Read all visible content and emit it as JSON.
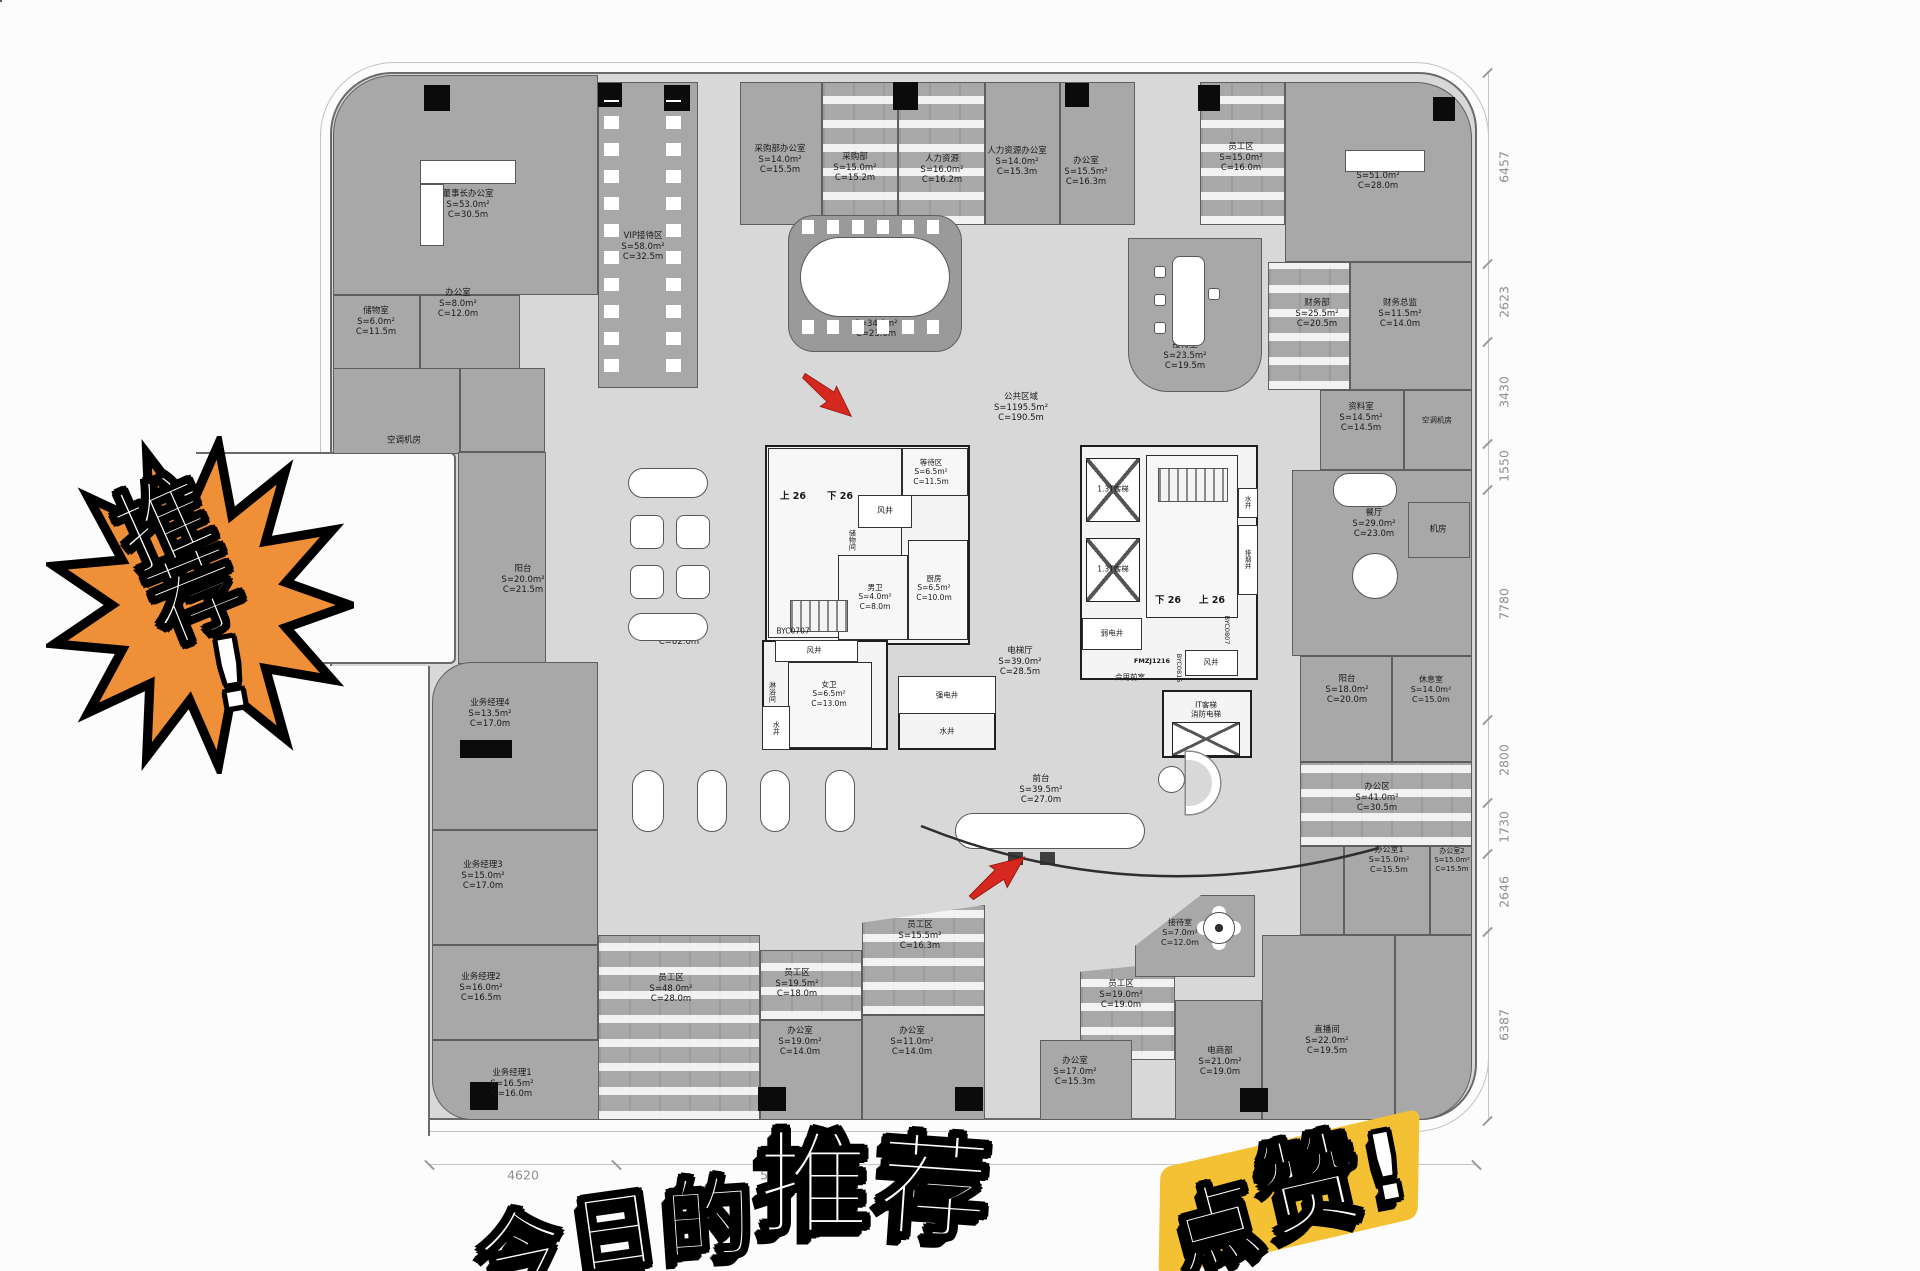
{
  "overlays": {
    "badge": {
      "text": "推荐!",
      "fill": "#ef8f38"
    },
    "title": {
      "text": "今日的推荐"
    },
    "like": {
      "text": "点赞!",
      "highlight": "#f4c134"
    }
  },
  "floorplan": {
    "public_area": {
      "name": "公共区域",
      "s": "S=1195.5m²",
      "c": "C=190.5m"
    },
    "rooms": [
      {
        "x": 333,
        "y": 75,
        "w": 265,
        "h": 220,
        "r": "60px 0 0 0"
      },
      {
        "x": 333,
        "y": 295,
        "w": 87,
        "h": 75
      },
      {
        "x": 420,
        "y": 295,
        "w": 100,
        "h": 75
      },
      {
        "x": 333,
        "y": 368,
        "w": 127,
        "h": 86
      },
      {
        "x": 460,
        "y": 368,
        "w": 85,
        "h": 84
      },
      {
        "x": 458,
        "y": 452,
        "w": 88,
        "h": 212
      },
      {
        "x": 598,
        "y": 82,
        "w": 100,
        "h": 306
      },
      {
        "x": 740,
        "y": 82,
        "w": 82,
        "h": 143
      },
      {
        "x": 822,
        "y": 82,
        "w": 76,
        "h": 143,
        "cls": "ws"
      },
      {
        "x": 898,
        "y": 82,
        "w": 87,
        "h": 143,
        "cls": "ws"
      },
      {
        "x": 985,
        "y": 82,
        "w": 75,
        "h": 143
      },
      {
        "x": 1060,
        "y": 82,
        "w": 75,
        "h": 143
      },
      {
        "x": 1200,
        "y": 82,
        "w": 85,
        "h": 143,
        "cls": "ws"
      },
      {
        "x": 1285,
        "y": 82,
        "w": 187,
        "h": 180,
        "r": "0 56px 0 0"
      },
      {
        "x": 788,
        "y": 215,
        "w": 174,
        "h": 137,
        "cls": "room2",
        "r": "26px"
      },
      {
        "x": 1128,
        "y": 238,
        "w": 134,
        "h": 154,
        "r": "0 0 40px 40px"
      },
      {
        "x": 1268,
        "y": 262,
        "w": 82,
        "h": 128,
        "cls": "ws"
      },
      {
        "x": 1350,
        "y": 262,
        "w": 122,
        "h": 128
      },
      {
        "x": 1320,
        "y": 390,
        "w": 84,
        "h": 80
      },
      {
        "x": 1404,
        "y": 390,
        "w": 68,
        "h": 80
      },
      {
        "x": 1292,
        "y": 470,
        "w": 180,
        "h": 186
      },
      {
        "x": 1408,
        "y": 502,
        "w": 62,
        "h": 56
      },
      {
        "x": 1300,
        "y": 656,
        "w": 92,
        "h": 106
      },
      {
        "x": 1392,
        "y": 656,
        "w": 80,
        "h": 106
      },
      {
        "x": 1300,
        "y": 762,
        "w": 172,
        "h": 84,
        "cls": "ws"
      },
      {
        "x": 1300,
        "y": 846,
        "w": 44,
        "h": 89
      },
      {
        "x": 1344,
        "y": 846,
        "w": 86,
        "h": 89
      },
      {
        "x": 1430,
        "y": 846,
        "w": 42,
        "h": 89
      },
      {
        "x": 432,
        "y": 662,
        "w": 166,
        "h": 168,
        "r": "40px 0 0 0"
      },
      {
        "x": 432,
        "y": 830,
        "w": 166,
        "h": 115
      },
      {
        "x": 432,
        "y": 945,
        "w": 166,
        "h": 95
      },
      {
        "x": 432,
        "y": 1040,
        "w": 208,
        "h": 80,
        "r": "0 0 0 40px"
      },
      {
        "x": 598,
        "y": 935,
        "w": 162,
        "h": 185,
        "cls": "ws"
      },
      {
        "x": 760,
        "y": 950,
        "w": 102,
        "h": 70,
        "cls": "ws"
      },
      {
        "x": 760,
        "y": 1020,
        "w": 102,
        "h": 100
      },
      {
        "x": 862,
        "y": 905,
        "w": 123,
        "h": 110,
        "cls": "ws",
        "clip": "polygon(0 16%,100% 0,100% 100%,0 100%)"
      },
      {
        "x": 862,
        "y": 1015,
        "w": 123,
        "h": 105
      },
      {
        "x": 1080,
        "y": 962,
        "w": 95,
        "h": 98,
        "cls": "ws",
        "clip": "polygon(0 10%,100% 0,100% 100%,0 100%)"
      },
      {
        "x": 1040,
        "y": 1040,
        "w": 92,
        "h": 80
      },
      {
        "x": 1135,
        "y": 895,
        "w": 120,
        "h": 82,
        "clip": "polygon(0 62%,55% 0,100% 0,100% 100%,0 100%)"
      },
      {
        "x": 1175,
        "y": 1000,
        "w": 87,
        "h": 120
      },
      {
        "x": 1262,
        "y": 935,
        "w": 133,
        "h": 185
      },
      {
        "x": 1395,
        "y": 935,
        "w": 77,
        "h": 185,
        "r": "0 0 54px 0"
      },
      {
        "x": 765,
        "y": 445,
        "w": 205,
        "h": 200,
        "cls": "core"
      },
      {
        "x": 768,
        "y": 448,
        "w": 134,
        "h": 190,
        "cls": "corew"
      },
      {
        "x": 858,
        "y": 495,
        "w": 54,
        "h": 33,
        "cls": "shaft"
      },
      {
        "x": 902,
        "y": 448,
        "w": 66,
        "h": 48,
        "cls": "corew"
      },
      {
        "x": 838,
        "y": 555,
        "w": 70,
        "h": 85,
        "cls": "corew"
      },
      {
        "x": 908,
        "y": 540,
        "w": 60,
        "h": 100,
        "cls": "corew"
      },
      {
        "x": 762,
        "y": 640,
        "w": 126,
        "h": 110,
        "cls": "core"
      },
      {
        "x": 775,
        "y": 640,
        "w": 83,
        "h": 22,
        "cls": "shaft"
      },
      {
        "x": 788,
        "y": 662,
        "w": 84,
        "h": 86,
        "cls": "corew"
      },
      {
        "x": 762,
        "y": 706,
        "w": 28,
        "h": 44,
        "cls": "shaft"
      },
      {
        "x": 898,
        "y": 676,
        "w": 98,
        "h": 74,
        "cls": "core"
      },
      {
        "x": 898,
        "y": 676,
        "w": 98,
        "h": 38,
        "cls": "shaft"
      },
      {
        "x": 1080,
        "y": 445,
        "w": 178,
        "h": 235,
        "cls": "core"
      },
      {
        "x": 1146,
        "y": 455,
        "w": 92,
        "h": 163,
        "cls": "corew"
      },
      {
        "x": 1238,
        "y": 488,
        "w": 20,
        "h": 30,
        "cls": "shaft"
      },
      {
        "x": 1238,
        "y": 525,
        "w": 20,
        "h": 70,
        "cls": "shaft"
      },
      {
        "x": 1082,
        "y": 618,
        "w": 60,
        "h": 32,
        "cls": "shaft"
      },
      {
        "x": 1185,
        "y": 650,
        "w": 53,
        "h": 26,
        "cls": "shaft"
      },
      {
        "x": 1162,
        "y": 690,
        "w": 90,
        "h": 68,
        "cls": "core"
      }
    ],
    "elevators": [
      {
        "x": 1086,
        "y": 458,
        "w": 54,
        "h": 64
      },
      {
        "x": 1086,
        "y": 538,
        "w": 54,
        "h": 64
      },
      {
        "x": 1172,
        "y": 722,
        "w": 68,
        "h": 34
      }
    ],
    "stairs": [
      {
        "x": 790,
        "y": 600,
        "w": 58,
        "h": 32
      },
      {
        "x": 1158,
        "y": 468,
        "w": 70,
        "h": 34
      }
    ],
    "columns": [
      {
        "x": 424,
        "y": 85,
        "w": 26,
        "h": 26
      },
      {
        "x": 598,
        "y": 83,
        "w": 24,
        "h": 24
      },
      {
        "x": 664,
        "y": 85,
        "w": 26,
        "h": 26
      },
      {
        "x": 893,
        "y": 82,
        "w": 25,
        "h": 28
      },
      {
        "x": 1065,
        "y": 83,
        "w": 24,
        "h": 24
      },
      {
        "x": 1198,
        "y": 85,
        "w": 22,
        "h": 26
      },
      {
        "x": 1433,
        "y": 97,
        "w": 22,
        "h": 24
      },
      {
        "x": 460,
        "y": 740,
        "w": 52,
        "h": 18
      },
      {
        "x": 470,
        "y": 1082,
        "w": 28,
        "h": 28
      },
      {
        "x": 758,
        "y": 1087,
        "w": 28,
        "h": 24
      },
      {
        "x": 955,
        "y": 1087,
        "w": 28,
        "h": 24
      },
      {
        "x": 1240,
        "y": 1088,
        "w": 28,
        "h": 24
      }
    ],
    "labels": [
      {
        "x": 468,
        "y": 205,
        "t": [
          "董事长办公室",
          "S=53.0m²",
          "C=30.5m"
        ]
      },
      {
        "x": 376,
        "y": 322,
        "t": [
          "储物室",
          "S=6.0m²",
          "C=11.5m"
        ]
      },
      {
        "x": 458,
        "y": 304,
        "t": [
          "办公室",
          "S=8.0m²",
          "C=12.0m"
        ]
      },
      {
        "x": 404,
        "y": 441,
        "t": [
          "空调机房"
        ]
      },
      {
        "x": 643,
        "y": 247,
        "t": [
          "VIP接待区",
          "S=58.0m²",
          "C=32.5m"
        ]
      },
      {
        "x": 780,
        "y": 160,
        "t": [
          "采购部办公室",
          "S=14.0m²",
          "C=15.5m"
        ]
      },
      {
        "x": 855,
        "y": 168,
        "t": [
          "采购部",
          "S=15.0m²",
          "C=15.2m"
        ]
      },
      {
        "x": 942,
        "y": 170,
        "t": [
          "人力资源",
          "S=16.0m²",
          "C=16.2m"
        ]
      },
      {
        "x": 1017,
        "y": 162,
        "t": [
          "人力资源办公室",
          "S=14.0m²",
          "C=15.3m"
        ]
      },
      {
        "x": 1086,
        "y": 172,
        "t": [
          "办公室",
          "S=15.5m²",
          "C=16.3m"
        ]
      },
      {
        "x": 1241,
        "y": 158,
        "t": [
          "员工区",
          "S=15.0m²",
          "C=16.0m"
        ]
      },
      {
        "x": 1378,
        "y": 176,
        "t": [
          "总裁办公室",
          "S=51.0m²",
          "C=28.0m"
        ]
      },
      {
        "x": 876,
        "y": 324,
        "t": [
          "会议室2",
          "S=34.0m²",
          "C=23.0m"
        ]
      },
      {
        "x": 1185,
        "y": 356,
        "t": [
          "接待室",
          "S=23.5m²",
          "C=19.5m"
        ]
      },
      {
        "x": 1317,
        "y": 314,
        "t": [
          "财务部",
          "S=25.5m²",
          "C=20.5m"
        ]
      },
      {
        "x": 1400,
        "y": 314,
        "t": [
          "财务总监",
          "S=11.5m²",
          "C=14.0m"
        ]
      },
      {
        "x": 1361,
        "y": 418,
        "t": [
          "资料室",
          "S=14.5m²",
          "C=14.5m"
        ]
      },
      {
        "x": 1437,
        "y": 420,
        "t": [
          "空调机房"
        ],
        "fs": 7.5
      },
      {
        "x": 1438,
        "y": 530,
        "t": [
          "机房"
        ]
      },
      {
        "x": 1374,
        "y": 524,
        "t": [
          "餐厅",
          "S=29.0m²",
          "C=23.0m"
        ]
      },
      {
        "x": 1347,
        "y": 690,
        "t": [
          "阳台",
          "S=18.0m²",
          "C=20.0m"
        ]
      },
      {
        "x": 1431,
        "y": 690,
        "t": [
          "休息室",
          "S=14.0m²",
          "C=15.0m"
        ],
        "fs": 8
      },
      {
        "x": 1377,
        "y": 798,
        "t": [
          "办公区",
          "S=41.0m²",
          "C=30.5m"
        ]
      },
      {
        "x": 1389,
        "y": 860,
        "t": [
          "办公室1",
          "S=15.0m²",
          "C=15.5m"
        ],
        "fs": 8
      },
      {
        "x": 1452,
        "y": 860,
        "t": [
          "办公室2",
          "S=15.0m²",
          "C=15.5m"
        ],
        "fs": 7
      },
      {
        "x": 523,
        "y": 580,
        "t": [
          "阳台",
          "S=20.0m²",
          "C=21.5m"
        ]
      },
      {
        "x": 679,
        "y": 632,
        "t": [
          "展厅",
          "S=112.0m²",
          "C=82.0m"
        ]
      },
      {
        "x": 1021,
        "y": 408,
        "t": [
          "公共区域",
          "S=1195.5m²",
          "C=190.5m"
        ]
      },
      {
        "x": 1020,
        "y": 662,
        "t": [
          "电梯厅",
          "S=39.0m²",
          "C=28.5m"
        ]
      },
      {
        "x": 1041,
        "y": 790,
        "t": [
          "前台",
          "S=39.5m²",
          "C=27.0m"
        ]
      },
      {
        "x": 490,
        "y": 714,
        "t": [
          "业务经理4",
          "S=13.5m²",
          "C=17.0m"
        ]
      },
      {
        "x": 483,
        "y": 876,
        "t": [
          "业务经理3",
          "S=15.0m²",
          "C=17.0m"
        ]
      },
      {
        "x": 481,
        "y": 988,
        "t": [
          "业务经理2",
          "S=16.0m²",
          "C=16.5m"
        ]
      },
      {
        "x": 512,
        "y": 1084,
        "t": [
          "业务经理1",
          "S=16.5m²",
          "C=16.0m"
        ]
      },
      {
        "x": 671,
        "y": 989,
        "t": [
          "员工区",
          "S=48.0m²",
          "C=28.0m"
        ]
      },
      {
        "x": 797,
        "y": 984,
        "t": [
          "员工区",
          "S=19.5m²",
          "C=18.0m"
        ]
      },
      {
        "x": 800,
        "y": 1042,
        "t": [
          "办公室",
          "S=19.0m²",
          "C=14.0m"
        ]
      },
      {
        "x": 920,
        "y": 936,
        "t": [
          "员工区",
          "S=15.5m²",
          "C=16.3m"
        ]
      },
      {
        "x": 912,
        "y": 1042,
        "t": [
          "办公室",
          "S=11.0m²",
          "C=14.0m"
        ]
      },
      {
        "x": 1121,
        "y": 995,
        "t": [
          "员工区",
          "S=19.0m²",
          "C=19.0m"
        ]
      },
      {
        "x": 1075,
        "y": 1072,
        "t": [
          "办公室",
          "S=17.0m²",
          "C=15.3m"
        ]
      },
      {
        "x": 1180,
        "y": 933,
        "t": [
          "接待室",
          "S=7.0m²",
          "C=12.0m"
        ],
        "fs": 8
      },
      {
        "x": 1220,
        "y": 1062,
        "t": [
          "电商部",
          "S=21.0m²",
          "C=19.0m"
        ]
      },
      {
        "x": 1327,
        "y": 1041,
        "t": [
          "直播间",
          "S=22.0m²",
          "C=19.5m"
        ]
      },
      {
        "x": 793,
        "y": 497,
        "t": [
          "上 26"
        ],
        "b": 1
      },
      {
        "x": 840,
        "y": 497,
        "t": [
          "下 26"
        ],
        "b": 1
      },
      {
        "x": 1168,
        "y": 601,
        "t": [
          "下 26"
        ],
        "b": 1
      },
      {
        "x": 1212,
        "y": 601,
        "t": [
          "上 26"
        ],
        "b": 1
      },
      {
        "x": 793,
        "y": 631,
        "t": [
          "BYC0707"
        ],
        "fs": 7.5
      },
      {
        "x": 885,
        "y": 511,
        "t": [
          "风井"
        ],
        "fs": 8
      },
      {
        "x": 875,
        "y": 597,
        "t": [
          "男卫",
          "S=4.0m²",
          "C=8.0m"
        ],
        "fs": 7.5
      },
      {
        "x": 934,
        "y": 588,
        "t": [
          "厨房",
          "S=6.5m²",
          "C=10.0m"
        ],
        "fs": 7.5
      },
      {
        "x": 931,
        "y": 472,
        "t": [
          "等待区",
          "S=6.5m²",
          "C=11.5m"
        ],
        "fs": 7.5
      },
      {
        "x": 852,
        "y": 540,
        "t": [
          "储物间"
        ],
        "fs": 7,
        "v": 1
      },
      {
        "x": 772,
        "y": 692,
        "t": [
          "淋浴间"
        ],
        "fs": 7,
        "v": 1
      },
      {
        "x": 829,
        "y": 694,
        "t": [
          "女卫",
          "S=6.5m²",
          "C=13.0m"
        ],
        "fs": 7.5
      },
      {
        "x": 776,
        "y": 728,
        "t": [
          "水井"
        ],
        "fs": 7,
        "v": 1
      },
      {
        "x": 814,
        "y": 650,
        "t": [
          "风井"
        ],
        "fs": 7.5
      },
      {
        "x": 947,
        "y": 695,
        "t": [
          "强电井"
        ],
        "fs": 7.5
      },
      {
        "x": 947,
        "y": 731,
        "t": [
          "水井"
        ],
        "fs": 7.5
      },
      {
        "x": 1112,
        "y": 633,
        "t": [
          "弱电井"
        ],
        "fs": 7.5
      },
      {
        "x": 1211,
        "y": 662,
        "t": [
          "风井"
        ],
        "fs": 7.5
      },
      {
        "x": 1130,
        "y": 677,
        "t": [
          "合用前室"
        ],
        "fs": 7.5
      },
      {
        "x": 1152,
        "y": 661,
        "t": [
          "FMZJ1216"
        ],
        "fs": 6.5,
        "b": 1
      },
      {
        "x": 1179,
        "y": 668,
        "t": [
          "BYC0815"
        ],
        "fs": 6.5,
        "v": 1
      },
      {
        "x": 1227,
        "y": 630,
        "t": [
          "BYC0807"
        ],
        "fs": 6.5,
        "v": 1
      },
      {
        "x": 1113,
        "y": 489,
        "t": [
          "1.3T客梯"
        ],
        "fs": 7.5
      },
      {
        "x": 1113,
        "y": 569,
        "t": [
          "1.3T客梯"
        ],
        "fs": 7.5
      },
      {
        "x": 1206,
        "y": 710,
        "t": [
          "IT客梯",
          "消防电梯"
        ],
        "fs": 7.5
      },
      {
        "x": 1247,
        "y": 502,
        "t": [
          "水井"
        ],
        "fs": 6.5,
        "v": 1
      },
      {
        "x": 1247,
        "y": 559,
        "t": [
          "排烟井"
        ],
        "fs": 6.5,
        "v": 1
      }
    ],
    "dims": {
      "right": {
        "line_x": 1488,
        "line_y1": 72,
        "line_y2": 1120,
        "labels": [
          {
            "v": "6457",
            "y": 167
          },
          {
            "v": "2623",
            "y": 302
          },
          {
            "v": "3430",
            "y": 392
          },
          {
            "v": "1550",
            "y": 466
          },
          {
            "v": "7780",
            "y": 604
          },
          {
            "v": "2800",
            "y": 760
          },
          {
            "v": "1730",
            "y": 827
          },
          {
            "v": "2646",
            "y": 892
          },
          {
            "v": "6387",
            "y": 1025
          }
        ],
        "ticks": [
          72,
          263,
          341,
          443,
          489,
          719,
          802,
          853,
          931,
          1120
        ]
      },
      "bottom": {
        "line_y": 1164,
        "line_x1": 430,
        "line_x2": 1477,
        "labels": [
          {
            "v": "4620",
            "x": 523
          },
          {
            "v": "5650",
            "x": 776
          },
          {
            "v": "8320",
            "x": 1397
          }
        ],
        "ticks": [
          430,
          617,
          845,
          1310,
          1477
        ]
      }
    }
  }
}
